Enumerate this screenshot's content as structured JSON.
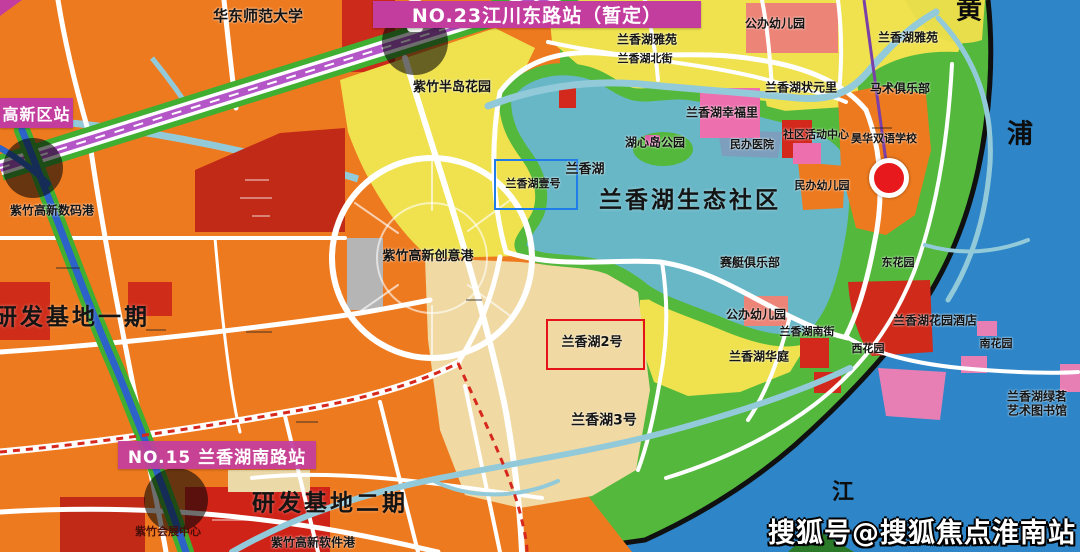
{
  "banners": {
    "no23": "NO.23江川东路站（暂定）",
    "no15": "NO.15 兰香湖南路站",
    "gaoxin": "高新区站"
  },
  "highlights": {
    "lot1": "兰香湖壹号",
    "lot2": "兰香湖2号"
  },
  "places": {
    "university": "华东师范大学",
    "peninsula_garden": "紫竹半岛花园",
    "north_street": "兰香湖北街",
    "yayuan_west": "兰香湖雅苑",
    "yayuan_east": "兰香湖雅苑",
    "public_kindergarten_north": "公办幼儿园",
    "zhuangyuanli": "兰香湖状元里",
    "xingfuli": "兰香湖幸福里",
    "equestrian_club": "马术俱乐部",
    "community_center": "社区活动中心",
    "bilingual_school": "昊华双语学校",
    "private_hospital": "民办医院",
    "island_park": "湖心岛公园",
    "private_kindergarten": "民办幼儿园",
    "lake": "兰香湖",
    "eco_community": "兰香湖生态社区",
    "rowing_club": "赛艇俱乐部",
    "digital_port": "紫竹高新数码港",
    "creative_port": "紫竹高新创意港",
    "rd_base_1": "研发基地一期",
    "public_kindergarten_south": "公办幼儿园",
    "south_street": "兰香湖南街",
    "huating": "兰香湖华庭",
    "west_garden": "西花园",
    "south_garden": "南花园",
    "east_garden": "东花园",
    "garden_hotel": "兰香湖花园酒店",
    "green_library_line1": "兰香湖绿茗",
    "green_library_line2": "艺术图书馆",
    "lot3": "兰香湖3号",
    "rd_base_2": "研发基地二期",
    "software_port": "紫竹高新软件港",
    "exhibition_center": "紫竹会展中心"
  },
  "river": {
    "huang": "黄",
    "pu": "浦",
    "jiang": "江"
  },
  "watermark": "搜狐号@搜狐焦点淮南站",
  "colors": {
    "banner_magenta": "#c33d9e",
    "highlight_blue": "#1f7ce8",
    "highlight_red": "#e51317",
    "marker_red": "#e8191d",
    "river_blue": "#2e86c8",
    "lake_teal": "#68b7c7",
    "park_green": "#53b83c",
    "parcel_orange": "#ee7a1f",
    "dark_red_parcel": "#c22a18",
    "yellow_parcel": "#efe24e",
    "tan_parcel": "#f0d9a2",
    "metro_purple": "#b455c8"
  }
}
